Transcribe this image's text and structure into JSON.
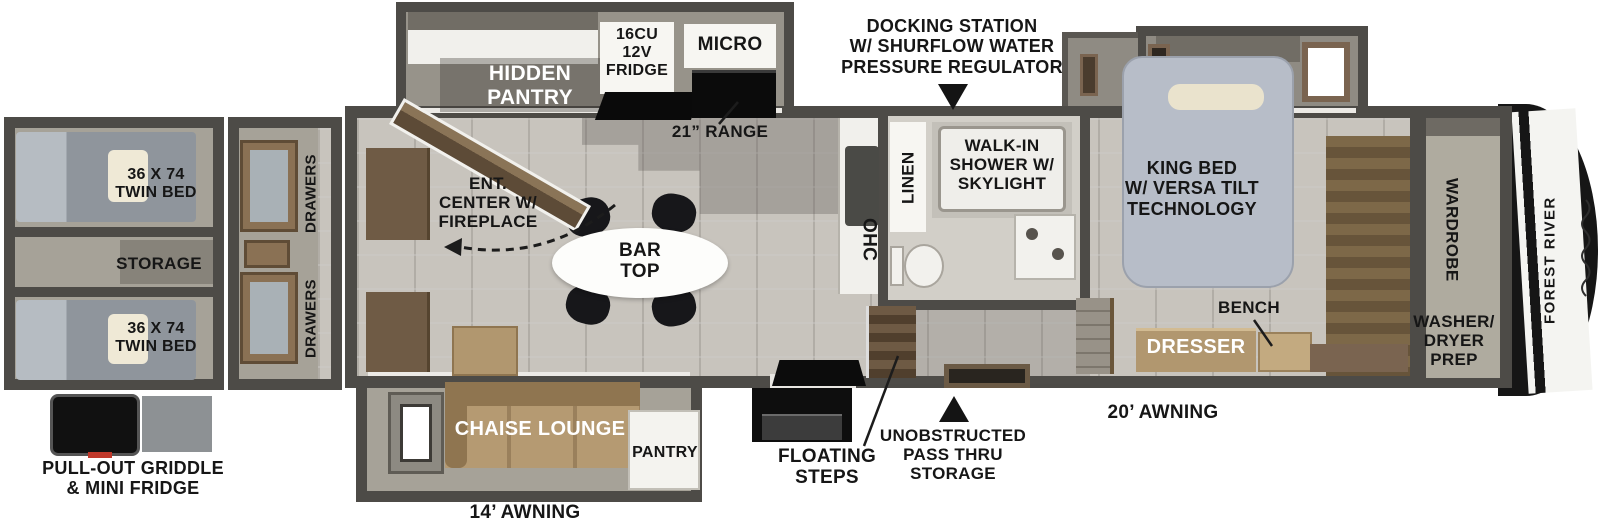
{
  "brand": {
    "name": "FOREST RIVER"
  },
  "colors": {
    "wall": "#4d4b47",
    "tile_floor": "#c8c4bd",
    "slide_floor": "#a6a298",
    "wood_dark": "#6f5b45",
    "wood_tan": "#b1976f",
    "bed_gray": "#b7bdc8",
    "appliance_black": "#0c0c0c",
    "label_dark": "#161616",
    "label_light": "#ffffff"
  },
  "exterior": {
    "docking": "DOCKING STATION\nW/ SHURFLOW WATER\nPRESSURE REGULATOR",
    "awning_14": "14’ AWNING",
    "awning_20": "20’ AWNING",
    "floating_steps": "FLOATING\nSTEPS",
    "pass_thru": "UNOBSTRUCTED\nPASS THRU\nSTORAGE",
    "griddle": "PULL-OUT GRIDDLE\n& MINI FRIDGE"
  },
  "kitchen": {
    "hidden_pantry": "HIDDEN\nPANTRY",
    "fridge": "16CU\n12V\nFRIDGE",
    "micro": "MICRO",
    "range": "21” RANGE",
    "ohc": "OHC",
    "bar_top": "BAR\nTOP",
    "pantry": "PANTRY"
  },
  "living": {
    "ent_center": "ENT.\nCENTER W/\nFIREPLACE",
    "chaise": "CHAISE LOUNGE"
  },
  "bath": {
    "linen": "LINEN",
    "shower": "WALK-IN\nSHOWER W/\nSKYLIGHT"
  },
  "bedroom": {
    "king_bed": "KING BED\nW/ VERSA TILT\nTECHNOLOGY",
    "bench": "BENCH",
    "dresser": "DRESSER",
    "wardrobe": "WARDROBE",
    "washer_dryer": "WASHER/\nDRYER\nPREP"
  },
  "bunk_room": {
    "twin_bed_upper": "36 X 74\nTWIN BED",
    "storage": "STORAGE",
    "twin_bed_lower": "36 X 74\nTWIN BED",
    "drawers_upper": "DRAWERS",
    "drawers_lower": "DRAWERS"
  }
}
